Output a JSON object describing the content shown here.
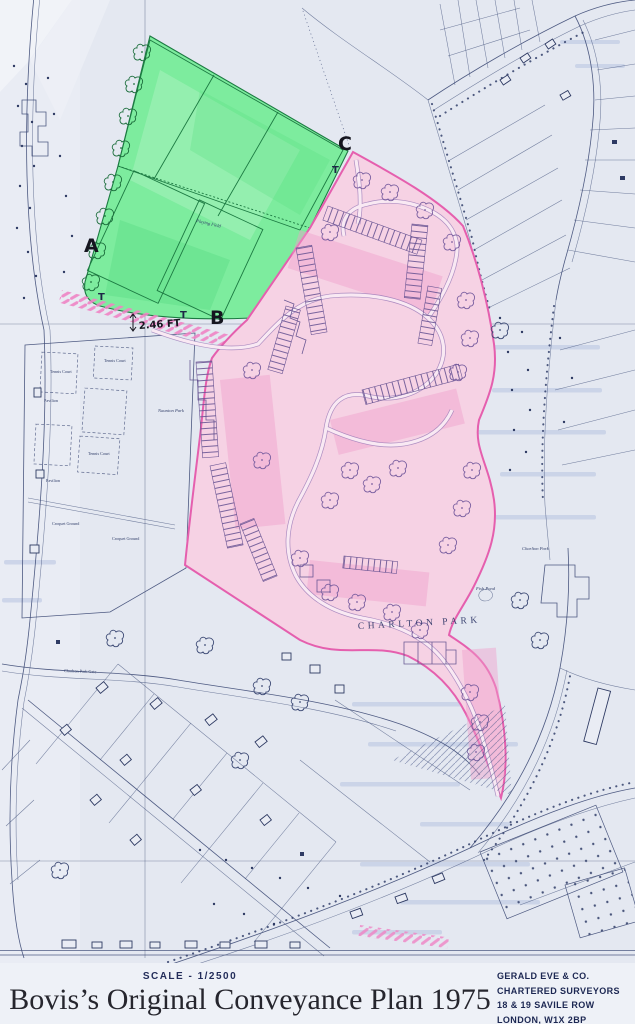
{
  "map": {
    "region_labels": {
      "a": "A",
      "b": "B",
      "c": "C",
      "t": "T",
      "frontage": "2.46 FT",
      "development": "CHARLTON PARK"
    },
    "feature_labels": {
      "playing_field": "Playing Field",
      "tennis_court": "Tennis Court",
      "croquet_ground": "Croquet Ground",
      "pavilion": "Pavilion",
      "park": "Naunton Park",
      "fish_pond": "Fish Pond",
      "school": "Charlton Park",
      "road": "Charlton Park Gate"
    },
    "colors": {
      "green_area": "#7dec9e",
      "pink_area": "#f6d2e4",
      "pink_outline": "#e55fae",
      "map_ink": "#3d4a75"
    }
  },
  "footer": {
    "scale": "SCALE - 1/2500",
    "title": "Bovis’s Original Conveyance Plan 1975",
    "surveyor": [
      "GERALD EVE & CO.",
      "CHARTERED SURVEYORS",
      "18 & 19 SAVILE ROW",
      "LONDON, W1X 2BP"
    ]
  }
}
